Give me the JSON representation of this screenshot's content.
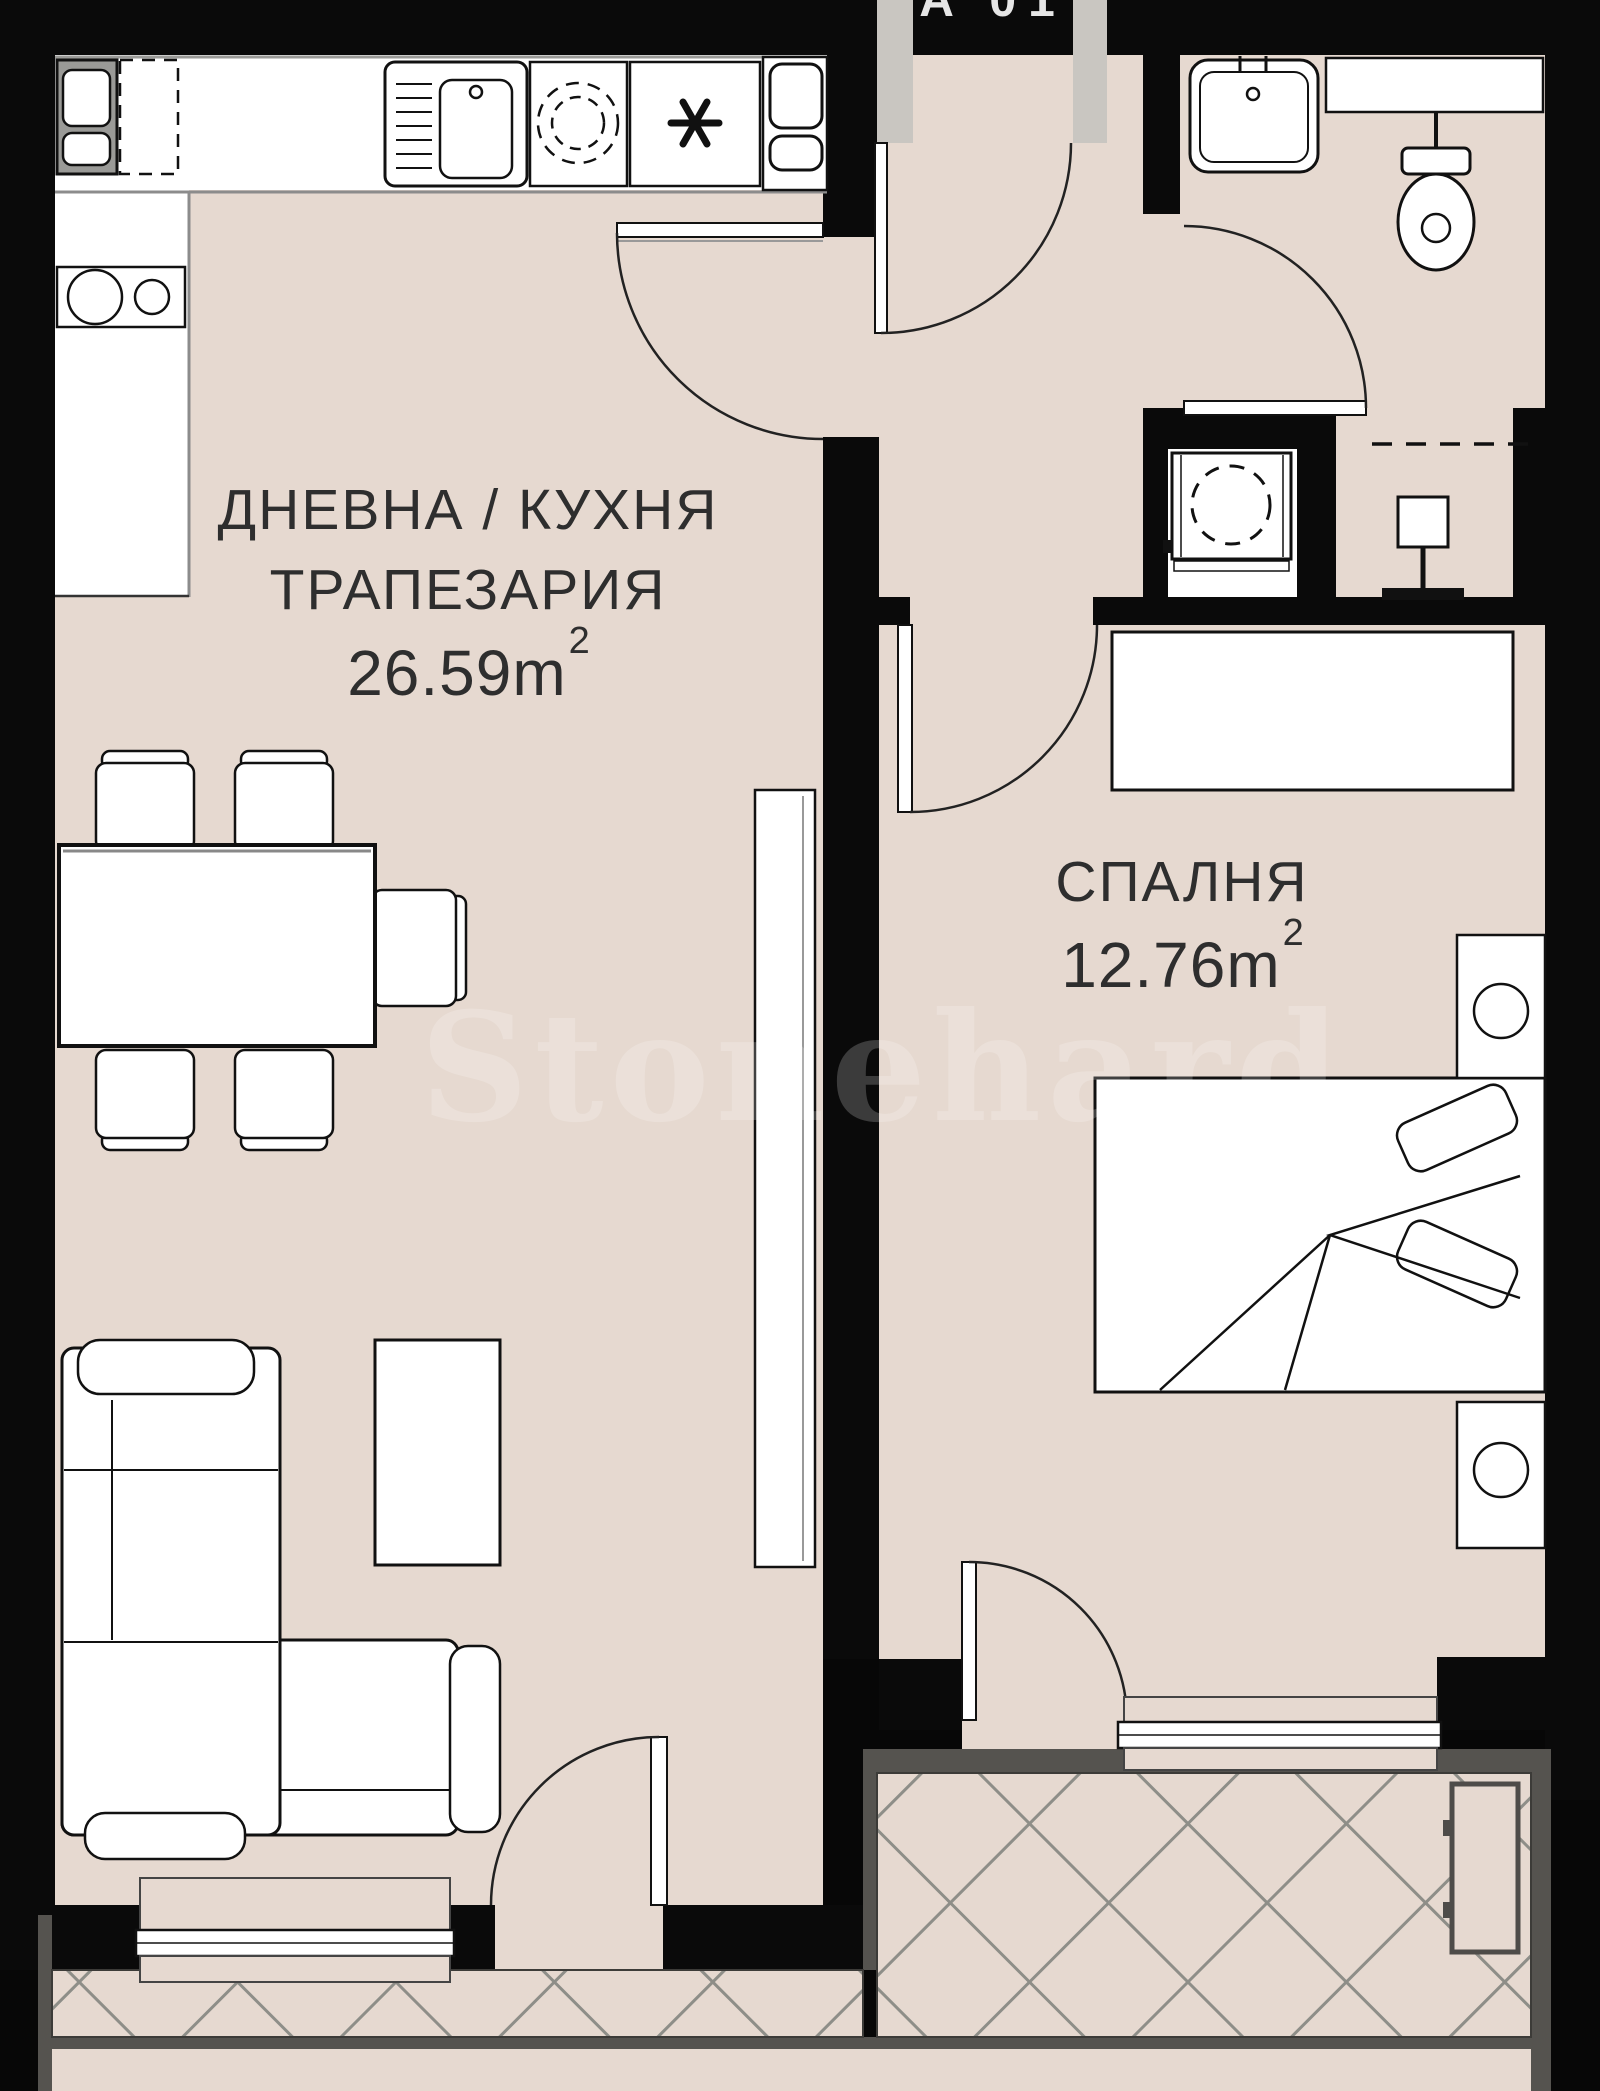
{
  "apartment": {
    "unit_label": "A 01"
  },
  "watermark": {
    "text": "Stonehard"
  },
  "rooms": {
    "living": {
      "line1": "ДНЕВНА / КУХНЯ",
      "line2": "ТРАПЕЗАРИЯ",
      "area_value": "26.59",
      "area_unit": "m",
      "area_exponent": "2"
    },
    "bedroom": {
      "name": "СПАЛНЯ",
      "area_value": "12.76",
      "area_unit": "m",
      "area_exponent": "2"
    }
  },
  "colors": {
    "wall": "#0a0a0a",
    "floor": "#e6d9d0",
    "fixture_fill": "#ffffff",
    "outline": "#1a1a1a",
    "railing": "#55534f",
    "hatch_line": "#8e8e88",
    "door_jamb": "#c9c6c1",
    "label_text": "#2e2e2e"
  }
}
